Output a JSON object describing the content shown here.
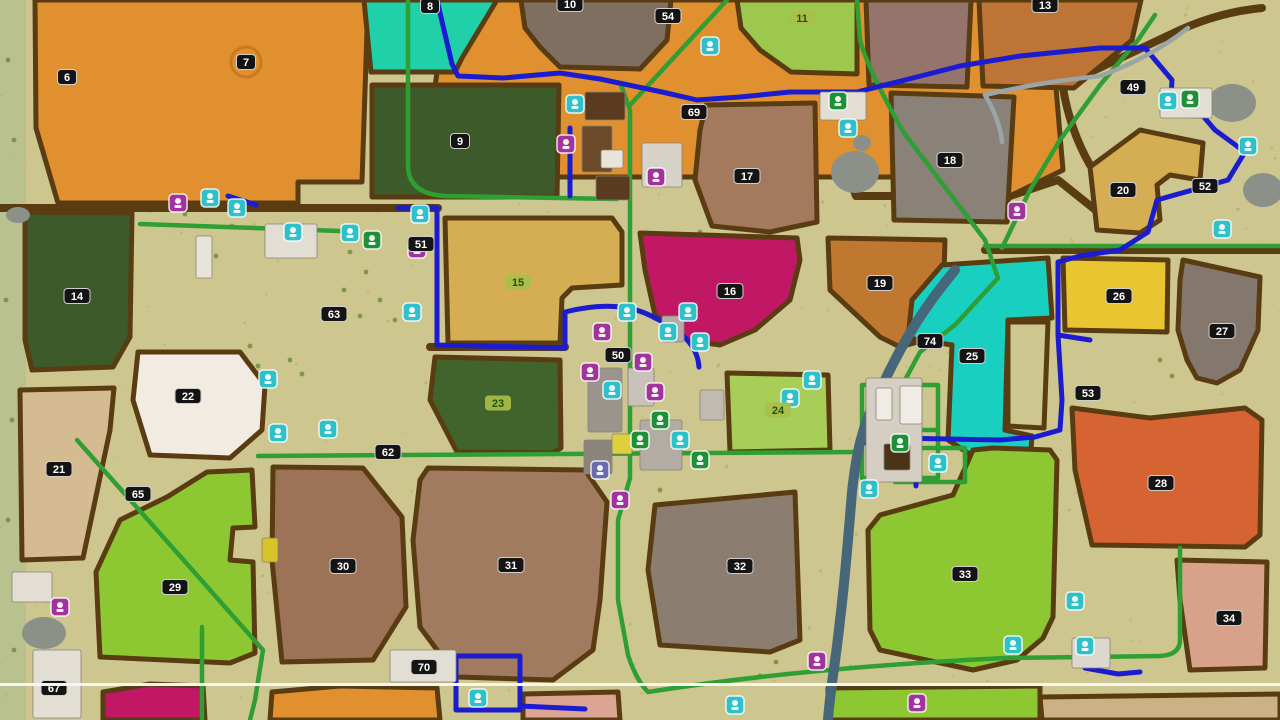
{
  "title": "Farm map overview",
  "map": {
    "base_color": "#cdc68f",
    "edge_strip_color": "#b9c18e",
    "road_brown": "#5a3c12",
    "path_green": "#2f9e33",
    "path_blue": "#1b1bd0",
    "river_color": "#46677a",
    "creek_color": "#9aa5a8",
    "pond_color": "#8b9089",
    "divider": {
      "y": 683,
      "color": "#f5f5f3"
    }
  },
  "badge_styles": {
    "black": {
      "bg": "#141414",
      "fg": "#ffffff",
      "border": "#cfcfcf"
    },
    "green": {
      "bg": "#a8bf49",
      "fg": "#245409",
      "border": "none"
    },
    "selected_ring_color": "#c87a20"
  },
  "icon_colors": {
    "teal": "#2fc1c9",
    "purple": "#a0349c",
    "green": "#1f9038",
    "blue": "#6a6ab0"
  },
  "fields": [
    {
      "num": "6",
      "fill": "#e0902e",
      "points": "35,0 368,0 362,182 298,182 298,203 58,203 36,128"
    },
    {
      "num": "7",
      "fill": "#e0902e",
      "points": "447,0 1062,0 1056,88 1063,170 1010,196 925,196 921,177 560,177 446,170 432,108"
    },
    {
      "num": "8",
      "fill": "#1fd0a8",
      "points": "364,0 497,0 462,58 455,72 371,72"
    },
    {
      "num": "10",
      "fill": "#7e6f60",
      "points": "521,0 671,0 667,40 640,69 560,67 540,47 525,28"
    },
    {
      "num": "9",
      "fill": "#3d5a2b",
      "points": "372,85 559,85 557,197 372,197"
    },
    {
      "num": "11",
      "fill": "#9cc84e",
      "points": "737,0 857,0 857,74 791,72 760,50 741,28"
    },
    {
      "num": "",
      "fill": "#95756b",
      "points": "866,0 971,0 967,87 869,85"
    },
    {
      "num": "13",
      "fill": "#bd7434",
      "points": "979,0 1141,0 1132,40 1074,88 983,86"
    },
    {
      "num": "14",
      "fill": "#3d5a2b",
      "points": "25,212 132,213 130,337 113,367 32,370 25,340"
    },
    {
      "num": "21",
      "fill": "#d5bb92",
      "points": "20,390 114,388 110,430 83,558 22,560"
    },
    {
      "num": "22",
      "fill": "#f1ebe2",
      "points": "138,352 240,352 265,385 262,430 230,458 150,455 133,400"
    },
    {
      "num": "15",
      "fill": "#d5ad53",
      "points": "445,218 612,218 622,232 622,285 572,288 562,298 560,343 448,343"
    },
    {
      "num": "16",
      "fill": "#c01864",
      "points": "640,233 797,238 800,260 790,300 755,330 720,345 688,340 655,315 645,270"
    },
    {
      "num": "17",
      "fill": "#a37a5e",
      "points": "706,105 815,103 817,222 770,232 712,226 695,180 700,130"
    },
    {
      "num": "18",
      "fill": "#8a8178",
      "points": "891,93 1014,97 1007,222 894,220"
    },
    {
      "num": "19",
      "fill": "#c0772f",
      "points": "828,238 945,240 943,308 925,340 900,347 880,337 830,290"
    },
    {
      "num": "20",
      "fill": "#d5ad53",
      "points": "1090,167 1140,130 1203,143 1200,180 1170,175 1157,185 1160,220 1140,233 1097,230"
    },
    {
      "num": "23",
      "fill": "#41632c",
      "points": "435,357 560,360 561,448 553,453 457,452 430,400"
    },
    {
      "num": "24",
      "fill": "#a7cf58",
      "points": "727,373 828,375 830,450 730,452"
    },
    {
      "num": "25",
      "fill": "#18cfc0",
      "points": "912,300 942,265 1048,258 1052,318 1008,320 1005,430 1032,436 1030,462 988,466 948,440 952,345 908,338"
    },
    {
      "num": "",
      "fill": "#cdc68f",
      "points": "1008,322 1048,322 1044,428 1008,426"
    },
    {
      "num": "26",
      "fill": "#e9c531",
      "points": "1063,258 1168,260 1167,332 1065,330"
    },
    {
      "num": "27",
      "fill": "#84776d",
      "points": "1183,260 1260,277 1258,330 1240,370 1217,383 1197,378 1187,360 1178,330 1180,280"
    },
    {
      "num": "28",
      "fill": "#d66332",
      "points": "1072,408 1150,418 1245,408 1262,420 1260,535 1245,547 1092,545 1075,470"
    },
    {
      "num": "29",
      "fill": "#8dc832",
      "points": "167,497 207,472 252,470 255,527 233,528 230,560 253,562 255,653 230,663 100,657 96,572 120,520"
    },
    {
      "num": "30",
      "fill": "#9c7357",
      "points": "273,467 363,468 402,517 406,607 373,660 282,662 272,560"
    },
    {
      "num": "31",
      "fill": "#a07b60",
      "points": "428,468 585,470 607,502 600,600 593,650 553,680 457,677 420,627 413,540 420,480"
    },
    {
      "num": "32",
      "fill": "#8b7d70",
      "points": "655,505 795,492 800,640 770,652 660,645 648,570"
    },
    {
      "num": "33",
      "fill": "#8dc832",
      "points": "880,515 953,495 973,450 993,448 1050,450 1057,460 1053,617 1043,638 1017,660 973,670 880,650 870,630 868,530"
    },
    {
      "num": "34",
      "fill": "#d7a289",
      "points": "1177,560 1267,562 1265,668 1190,670 1180,600"
    },
    {
      "num": "",
      "fill": "#c01864",
      "points": "103,692 150,684 203,686 205,720 103,720"
    },
    {
      "num": "",
      "fill": "#e0902e",
      "points": "272,692 340,686 437,688 440,720 270,720"
    },
    {
      "num": "",
      "fill": "#dca593",
      "points": "523,694 618,692 620,720 523,720"
    },
    {
      "num": "",
      "fill": "#8dc832",
      "points": "828,688 1040,686 1040,720 828,720"
    },
    {
      "num": "",
      "fill": "#cbb285",
      "points": "1040,697 1280,694 1280,720 1042,720"
    }
  ],
  "labels": [
    {
      "n": "6",
      "x": 67,
      "y": 77,
      "s": "black"
    },
    {
      "n": "7",
      "x": 246,
      "y": 62,
      "s": "black",
      "ring": true
    },
    {
      "n": "8",
      "x": 430,
      "y": 6,
      "s": "black"
    },
    {
      "n": "9",
      "x": 460,
      "y": 141,
      "s": "black"
    },
    {
      "n": "10",
      "x": 570,
      "y": 4,
      "s": "black"
    },
    {
      "n": "11",
      "x": 802,
      "y": 18,
      "s": "green"
    },
    {
      "n": "13",
      "x": 1045,
      "y": 5,
      "s": "black"
    },
    {
      "n": "14",
      "x": 77,
      "y": 296,
      "s": "black"
    },
    {
      "n": "15",
      "x": 518,
      "y": 282,
      "s": "green"
    },
    {
      "n": "16",
      "x": 730,
      "y": 291,
      "s": "black"
    },
    {
      "n": "17",
      "x": 747,
      "y": 176,
      "s": "black"
    },
    {
      "n": "18",
      "x": 950,
      "y": 160,
      "s": "black"
    },
    {
      "n": "19",
      "x": 880,
      "y": 283,
      "s": "black"
    },
    {
      "n": "20",
      "x": 1123,
      "y": 190,
      "s": "black"
    },
    {
      "n": "21",
      "x": 59,
      "y": 469,
      "s": "black"
    },
    {
      "n": "22",
      "x": 188,
      "y": 396,
      "s": "black"
    },
    {
      "n": "23",
      "x": 498,
      "y": 403,
      "s": "green"
    },
    {
      "n": "24",
      "x": 778,
      "y": 410,
      "s": "green"
    },
    {
      "n": "25",
      "x": 972,
      "y": 356,
      "s": "black"
    },
    {
      "n": "26",
      "x": 1119,
      "y": 296,
      "s": "black"
    },
    {
      "n": "27",
      "x": 1222,
      "y": 331,
      "s": "black"
    },
    {
      "n": "28",
      "x": 1161,
      "y": 483,
      "s": "black"
    },
    {
      "n": "29",
      "x": 175,
      "y": 587,
      "s": "black"
    },
    {
      "n": "30",
      "x": 343,
      "y": 566,
      "s": "black"
    },
    {
      "n": "31",
      "x": 511,
      "y": 565,
      "s": "black"
    },
    {
      "n": "32",
      "x": 740,
      "y": 566,
      "s": "black"
    },
    {
      "n": "33",
      "x": 965,
      "y": 574,
      "s": "black"
    },
    {
      "n": "34",
      "x": 1229,
      "y": 618,
      "s": "black"
    },
    {
      "n": "49",
      "x": 1133,
      "y": 87,
      "s": "black"
    },
    {
      "n": "50",
      "x": 618,
      "y": 355,
      "s": "black"
    },
    {
      "n": "51",
      "x": 421,
      "y": 244,
      "s": "black"
    },
    {
      "n": "52",
      "x": 1205,
      "y": 186,
      "s": "black"
    },
    {
      "n": "53",
      "x": 1088,
      "y": 393,
      "s": "black"
    },
    {
      "n": "54",
      "x": 668,
      "y": 16,
      "s": "black"
    },
    {
      "n": "62",
      "x": 388,
      "y": 452,
      "s": "black"
    },
    {
      "n": "63",
      "x": 334,
      "y": 314,
      "s": "black"
    },
    {
      "n": "65",
      "x": 138,
      "y": 494,
      "s": "black"
    },
    {
      "n": "67",
      "x": 54,
      "y": 688,
      "s": "black"
    },
    {
      "n": "69",
      "x": 694,
      "y": 112,
      "s": "black"
    },
    {
      "n": "70",
      "x": 424,
      "y": 667,
      "s": "black"
    },
    {
      "n": "74",
      "x": 930,
      "y": 341,
      "s": "black"
    }
  ],
  "roads": {
    "brown": [
      "M0,208 L438,208",
      "M432,174 L848,174 L856,196 L1010,196",
      "M1010,196 L1058,180 L1098,212 L1140,228",
      "M1063,85 Q1120,58 1180,30 Q1220,12 1262,8",
      "M1063,88 Q1070,130 1090,165",
      "M985,250 L1280,250",
      "M430,347 L565,347",
      "M868,88 L971,88"
    ],
    "green": [
      "M408,0 L408,165 Q408,194 445,196 L617,199",
      "M621,85 L630,110 L630,478 L618,520 L618,600 L628,655 Q636,680 648,692 Q800,668 1005,658 L1160,656 Q1180,655 1180,640 L1180,548",
      "M630,105 L727,0",
      "M857,0 L860,40 Q868,70 904,133 L985,240 L998,278 L955,325 L920,352 L905,380",
      "M1155,15 L1138,40 L1100,85 L1060,140 L1030,190 L1002,248",
      "M985,246 L1280,246",
      "M140,224 L340,231",
      "M258,456 L862,452",
      "M77,440 L180,556 L263,650 L255,700 L250,720",
      "M202,627 L202,720",
      "M862,385 L938,385 L938,478 L862,478 Z",
      "M862,430 L938,430",
      "M898,385 L898,478",
      "M895,448 L965,448 L965,482 L895,482 Z"
    ],
    "blue": [
      "M437,0 L444,30 L452,64 L458,76 L503,78 L560,73 L600,79 L662,92 L697,100 L740,97 L790,92 L857,92 L905,80 L960,66 L1020,56 L1100,48 L1145,48 L1172,80 L1170,115 L1203,116 L1215,130 L1245,152 L1228,180 L1157,200 L1148,232 L1120,250 L1080,256 L1058,262 L1058,335 L1062,400 L1060,430 L1035,437 L1000,440 L895,438 L862,443",
      "M1058,335 L1090,340",
      "M398,208 L437,208 L437,345 L565,348 L565,312 Q620,298 655,318 Q697,337 699,367",
      "M228,196 L256,205",
      "M570,128 L570,196",
      "M916,462 L916,486",
      "M456,656 L520,656 L520,710 L456,710 Z",
      "M520,706 L585,709",
      "M1085,640 L1085,668 L1118,674 L1140,672"
    ]
  },
  "water": {
    "rivers": [
      "M955,270 C930,300 905,335 878,395 C862,425 856,455 852,492 C848,540 845,580 840,620 C836,660 830,690 828,720"
    ],
    "creeks": [
      "M985,95 Q1040,82 1100,76 Q1150,58 1188,28",
      "M985,95 Q1000,120 1002,142"
    ],
    "ponds": [
      {
        "cx": 18,
        "cy": 215,
        "rx": 12,
        "ry": 8
      },
      {
        "cx": 855,
        "cy": 172,
        "rx": 24,
        "ry": 21
      },
      {
        "cx": 862,
        "cy": 143,
        "rx": 9,
        "ry": 8
      },
      {
        "cx": 1232,
        "cy": 103,
        "rx": 24,
        "ry": 19
      },
      {
        "cx": 1263,
        "cy": 190,
        "rx": 20,
        "ry": 17
      },
      {
        "cx": 44,
        "cy": 633,
        "rx": 22,
        "ry": 16
      }
    ]
  },
  "structures": [
    {
      "x": 585,
      "y": 92,
      "w": 40,
      "h": 28,
      "fill": "#5a3b20"
    },
    {
      "x": 582,
      "y": 126,
      "w": 30,
      "h": 46,
      "fill": "#6b4a2a"
    },
    {
      "x": 596,
      "y": 176,
      "w": 34,
      "h": 24,
      "fill": "#5a3b20"
    },
    {
      "x": 601,
      "y": 150,
      "w": 22,
      "h": 18,
      "fill": "#e8e4da"
    },
    {
      "x": 588,
      "y": 368,
      "w": 34,
      "h": 64,
      "fill": "#9a948c"
    },
    {
      "x": 640,
      "y": 420,
      "w": 42,
      "h": 50,
      "fill": "#b2aca4"
    },
    {
      "x": 628,
      "y": 368,
      "w": 26,
      "h": 38,
      "fill": "#c8c2ba"
    },
    {
      "x": 662,
      "y": 316,
      "w": 22,
      "h": 26,
      "fill": "#b2aca4"
    },
    {
      "x": 700,
      "y": 390,
      "w": 24,
      "h": 30,
      "fill": "#c0bab2"
    },
    {
      "x": 584,
      "y": 440,
      "w": 28,
      "h": 34,
      "fill": "#8a847c"
    },
    {
      "x": 265,
      "y": 224,
      "w": 52,
      "h": 34,
      "fill": "#e3ded4"
    },
    {
      "x": 820,
      "y": 92,
      "w": 46,
      "h": 28,
      "fill": "#e3ded4"
    },
    {
      "x": 1160,
      "y": 88,
      "w": 52,
      "h": 30,
      "fill": "#e3ded4"
    },
    {
      "x": 390,
      "y": 650,
      "w": 66,
      "h": 32,
      "fill": "#e3ded4"
    },
    {
      "x": 33,
      "y": 650,
      "w": 48,
      "h": 68,
      "fill": "#e3ded4"
    },
    {
      "x": 1072,
      "y": 638,
      "w": 38,
      "h": 30,
      "fill": "#ddd8ce"
    },
    {
      "x": 866,
      "y": 378,
      "w": 56,
      "h": 104,
      "fill": "#d5cfc3"
    },
    {
      "x": 876,
      "y": 388,
      "w": 16,
      "h": 32,
      "fill": "#efece6"
    },
    {
      "x": 900,
      "y": 386,
      "w": 22,
      "h": 38,
      "fill": "#efece6"
    },
    {
      "x": 884,
      "y": 444,
      "w": 26,
      "h": 26,
      "fill": "#4a3418"
    },
    {
      "x": 196,
      "y": 236,
      "w": 16,
      "h": 42,
      "fill": "#e8e4da"
    },
    {
      "x": 12,
      "y": 572,
      "w": 40,
      "h": 30,
      "fill": "#e3ded4"
    },
    {
      "x": 642,
      "y": 143,
      "w": 40,
      "h": 44,
      "fill": "#d8d3c9"
    },
    {
      "x": 262,
      "y": 538,
      "w": 16,
      "h": 24,
      "fill": "#d8c32a"
    },
    {
      "x": 612,
      "y": 434,
      "w": 20,
      "h": 20,
      "fill": "#dfcf3f"
    }
  ],
  "icons": [
    {
      "x": 710,
      "y": 46,
      "c": "teal",
      "name": "station-poi-icon"
    },
    {
      "x": 575,
      "y": 104,
      "c": "teal",
      "name": "station-poi-icon"
    },
    {
      "x": 566,
      "y": 144,
      "c": "purple",
      "name": "production-poi-icon"
    },
    {
      "x": 656,
      "y": 177,
      "c": "purple",
      "name": "animal-dealer-poi-icon"
    },
    {
      "x": 838,
      "y": 101,
      "c": "green",
      "name": "sellpoint-poi-icon"
    },
    {
      "x": 848,
      "y": 128,
      "c": "teal",
      "name": "station-poi-icon"
    },
    {
      "x": 178,
      "y": 203,
      "c": "purple",
      "name": "production-poi-icon"
    },
    {
      "x": 210,
      "y": 198,
      "c": "teal",
      "name": "station-poi-icon"
    },
    {
      "x": 237,
      "y": 208,
      "c": "teal",
      "name": "station-poi-icon"
    },
    {
      "x": 293,
      "y": 232,
      "c": "teal",
      "name": "station-poi-icon"
    },
    {
      "x": 350,
      "y": 233,
      "c": "teal",
      "name": "station-poi-icon"
    },
    {
      "x": 372,
      "y": 240,
      "c": "green",
      "name": "sellpoint-poi-icon"
    },
    {
      "x": 420,
      "y": 214,
      "c": "teal",
      "name": "station-poi-icon"
    },
    {
      "x": 417,
      "y": 249,
      "c": "purple",
      "name": "production-poi-icon"
    },
    {
      "x": 412,
      "y": 312,
      "c": "teal",
      "name": "station-poi-icon"
    },
    {
      "x": 268,
      "y": 379,
      "c": "teal",
      "name": "station-poi-icon"
    },
    {
      "x": 278,
      "y": 433,
      "c": "teal",
      "name": "station-poi-icon"
    },
    {
      "x": 328,
      "y": 429,
      "c": "teal",
      "name": "station-poi-icon"
    },
    {
      "x": 602,
      "y": 332,
      "c": "purple",
      "name": "production-poi-icon"
    },
    {
      "x": 627,
      "y": 312,
      "c": "teal",
      "name": "station-poi-icon"
    },
    {
      "x": 643,
      "y": 362,
      "c": "purple",
      "name": "production-poi-icon"
    },
    {
      "x": 655,
      "y": 392,
      "c": "purple",
      "name": "production-poi-icon"
    },
    {
      "x": 668,
      "y": 332,
      "c": "teal",
      "name": "station-poi-icon"
    },
    {
      "x": 700,
      "y": 342,
      "c": "teal",
      "name": "station-poi-icon"
    },
    {
      "x": 688,
      "y": 312,
      "c": "teal",
      "name": "station-poi-icon"
    },
    {
      "x": 612,
      "y": 390,
      "c": "teal",
      "name": "station-poi-icon"
    },
    {
      "x": 590,
      "y": 372,
      "c": "purple",
      "name": "production-poi-icon"
    },
    {
      "x": 660,
      "y": 420,
      "c": "green",
      "name": "sellpoint-poi-icon"
    },
    {
      "x": 640,
      "y": 440,
      "c": "green",
      "name": "sellpoint-poi-icon"
    },
    {
      "x": 680,
      "y": 440,
      "c": "teal",
      "name": "station-poi-icon"
    },
    {
      "x": 700,
      "y": 460,
      "c": "green",
      "name": "sellpoint-poi-icon"
    },
    {
      "x": 600,
      "y": 470,
      "c": "blue",
      "name": "garage-poi-icon"
    },
    {
      "x": 620,
      "y": 500,
      "c": "purple",
      "name": "production-poi-icon"
    },
    {
      "x": 790,
      "y": 398,
      "c": "teal",
      "name": "station-poi-icon"
    },
    {
      "x": 812,
      "y": 380,
      "c": "teal",
      "name": "station-poi-icon"
    },
    {
      "x": 869,
      "y": 489,
      "c": "teal",
      "name": "station-poi-icon"
    },
    {
      "x": 938,
      "y": 463,
      "c": "teal",
      "name": "station-poi-icon"
    },
    {
      "x": 900,
      "y": 443,
      "c": "green",
      "name": "sellpoint-poi-icon"
    },
    {
      "x": 1017,
      "y": 211,
      "c": "purple",
      "name": "production-poi-icon"
    },
    {
      "x": 1168,
      "y": 101,
      "c": "teal",
      "name": "station-poi-icon"
    },
    {
      "x": 1190,
      "y": 99,
      "c": "green",
      "name": "sellpoint-poi-icon"
    },
    {
      "x": 1248,
      "y": 146,
      "c": "teal",
      "name": "station-poi-icon"
    },
    {
      "x": 1222,
      "y": 229,
      "c": "teal",
      "name": "station-poi-icon"
    },
    {
      "x": 1075,
      "y": 601,
      "c": "teal",
      "name": "station-poi-icon"
    },
    {
      "x": 1085,
      "y": 646,
      "c": "teal",
      "name": "station-poi-icon"
    },
    {
      "x": 478,
      "y": 698,
      "c": "teal",
      "name": "station-poi-icon"
    },
    {
      "x": 817,
      "y": 661,
      "c": "purple",
      "name": "production-poi-icon"
    },
    {
      "x": 1013,
      "y": 645,
      "c": "teal",
      "name": "station-poi-icon"
    },
    {
      "x": 735,
      "y": 705,
      "c": "teal",
      "name": "station-poi-icon"
    },
    {
      "x": 917,
      "y": 703,
      "c": "purple",
      "name": "production-poi-icon"
    },
    {
      "x": 60,
      "y": 607,
      "c": "purple",
      "name": "production-poi-icon"
    }
  ],
  "vegetation": [
    [
      150,
      210
    ],
    [
      165,
      225
    ],
    [
      185,
      214
    ],
    [
      200,
      242
    ],
    [
      216,
      256
    ],
    [
      232,
      226
    ],
    [
      350,
      252
    ],
    [
      366,
      272
    ],
    [
      380,
      300
    ],
    [
      395,
      320
    ],
    [
      360,
      316
    ],
    [
      344,
      290
    ],
    [
      660,
      60
    ],
    [
      676,
      76
    ],
    [
      692,
      62
    ],
    [
      258,
      366
    ],
    [
      250,
      346
    ],
    [
      700,
      232
    ],
    [
      718,
      242
    ],
    [
      95,
      426
    ],
    [
      108,
      438
    ],
    [
      1160,
      360
    ],
    [
      1172,
      376
    ],
    [
      760,
      676
    ],
    [
      776,
      662
    ],
    [
      952,
      700
    ],
    [
      660,
      490
    ],
    [
      672,
      506
    ],
    [
      290,
      360
    ],
    [
      302,
      374
    ],
    [
      8,
      60
    ],
    [
      14,
      140
    ],
    [
      6,
      300
    ],
    [
      12,
      420
    ],
    [
      8,
      520
    ],
    [
      14,
      650
    ]
  ]
}
